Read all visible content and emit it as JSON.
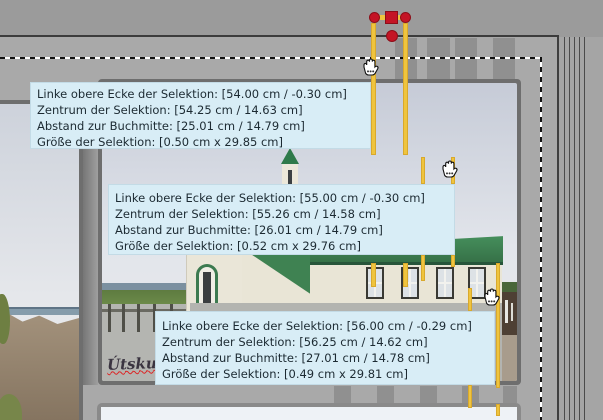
{
  "canvas": {
    "tooltips": [
      {
        "lines": [
          "Linke obere Ecke der Selektion: [54.00 cm / -0.30 cm]",
          "Zentrum der Selektion: [54.25 cm / 14.63 cm]",
          "Abstand zur Buchmitte: [25.01 cm / 14.79 cm]",
          "Größe der Selektion: [0.50 cm x 29.85 cm]"
        ]
      },
      {
        "lines": [
          "Linke obere Ecke der Selektion: [55.00 cm / -0.30 cm]",
          "Zentrum der Selektion: [55.26 cm / 14.58 cm]",
          "Abstand zur Buchmitte: [26.01 cm / 14.79 cm]",
          "Größe der Selektion: [0.52 cm x 29.76 cm]"
        ]
      },
      {
        "lines": [
          "Linke obere Ecke der Selektion: [56.00 cm / -0.29 cm]",
          "Zentrum der Selektion: [56.25 cm / 14.62 cm]",
          "Abstand zur Buchmitte: [27.01 cm / 14.78 cm]",
          "Größe der Selektion: [0.49 cm x 29.81 cm]"
        ]
      }
    ],
    "photo_caption": "Útsku",
    "colors": {
      "guide_yellow": "#efc43e",
      "handle_red": "#c41425",
      "tooltip_bg": "#d8edf6",
      "page_gray": "#a9a9a9",
      "pasteboard_gray": "#9b9b9b",
      "roof_green": "#3f8252"
    },
    "icons": [
      "drag-hand-cursor",
      "selection-handle",
      "guide-line"
    ]
  }
}
